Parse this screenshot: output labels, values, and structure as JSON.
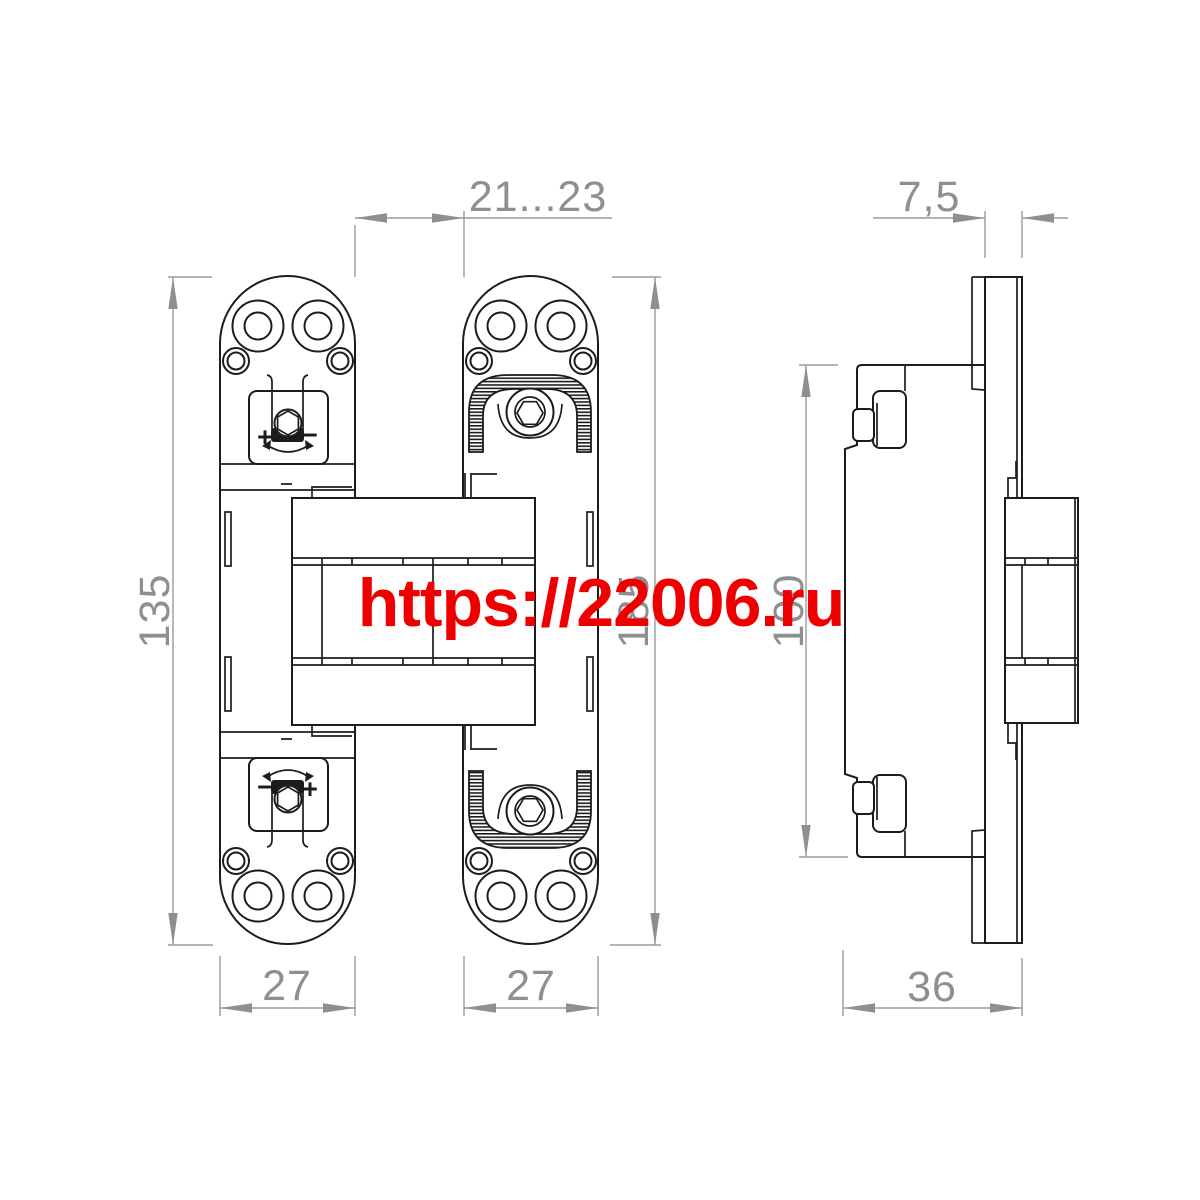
{
  "watermark": {
    "text": "https://22006.ru",
    "color": "#ee0000"
  },
  "dimensions": {
    "front_top_gap": "21...23",
    "front_left_height": "135",
    "front_right_height": "185",
    "front_left_width": "27",
    "front_right_width": "27",
    "side_plate_thickness": "7,5",
    "side_body_height": "100",
    "side_depth": "36"
  },
  "adjustment": {
    "top_left_sign": "+",
    "top_right_sign": "−",
    "bottom_left_sign": "−",
    "bottom_right_sign": "+"
  },
  "colors": {
    "drawing_line": "#1c1c1c",
    "dimension": "#8f8f8f",
    "watermark": "#ee0000",
    "background": "#ffffff"
  }
}
